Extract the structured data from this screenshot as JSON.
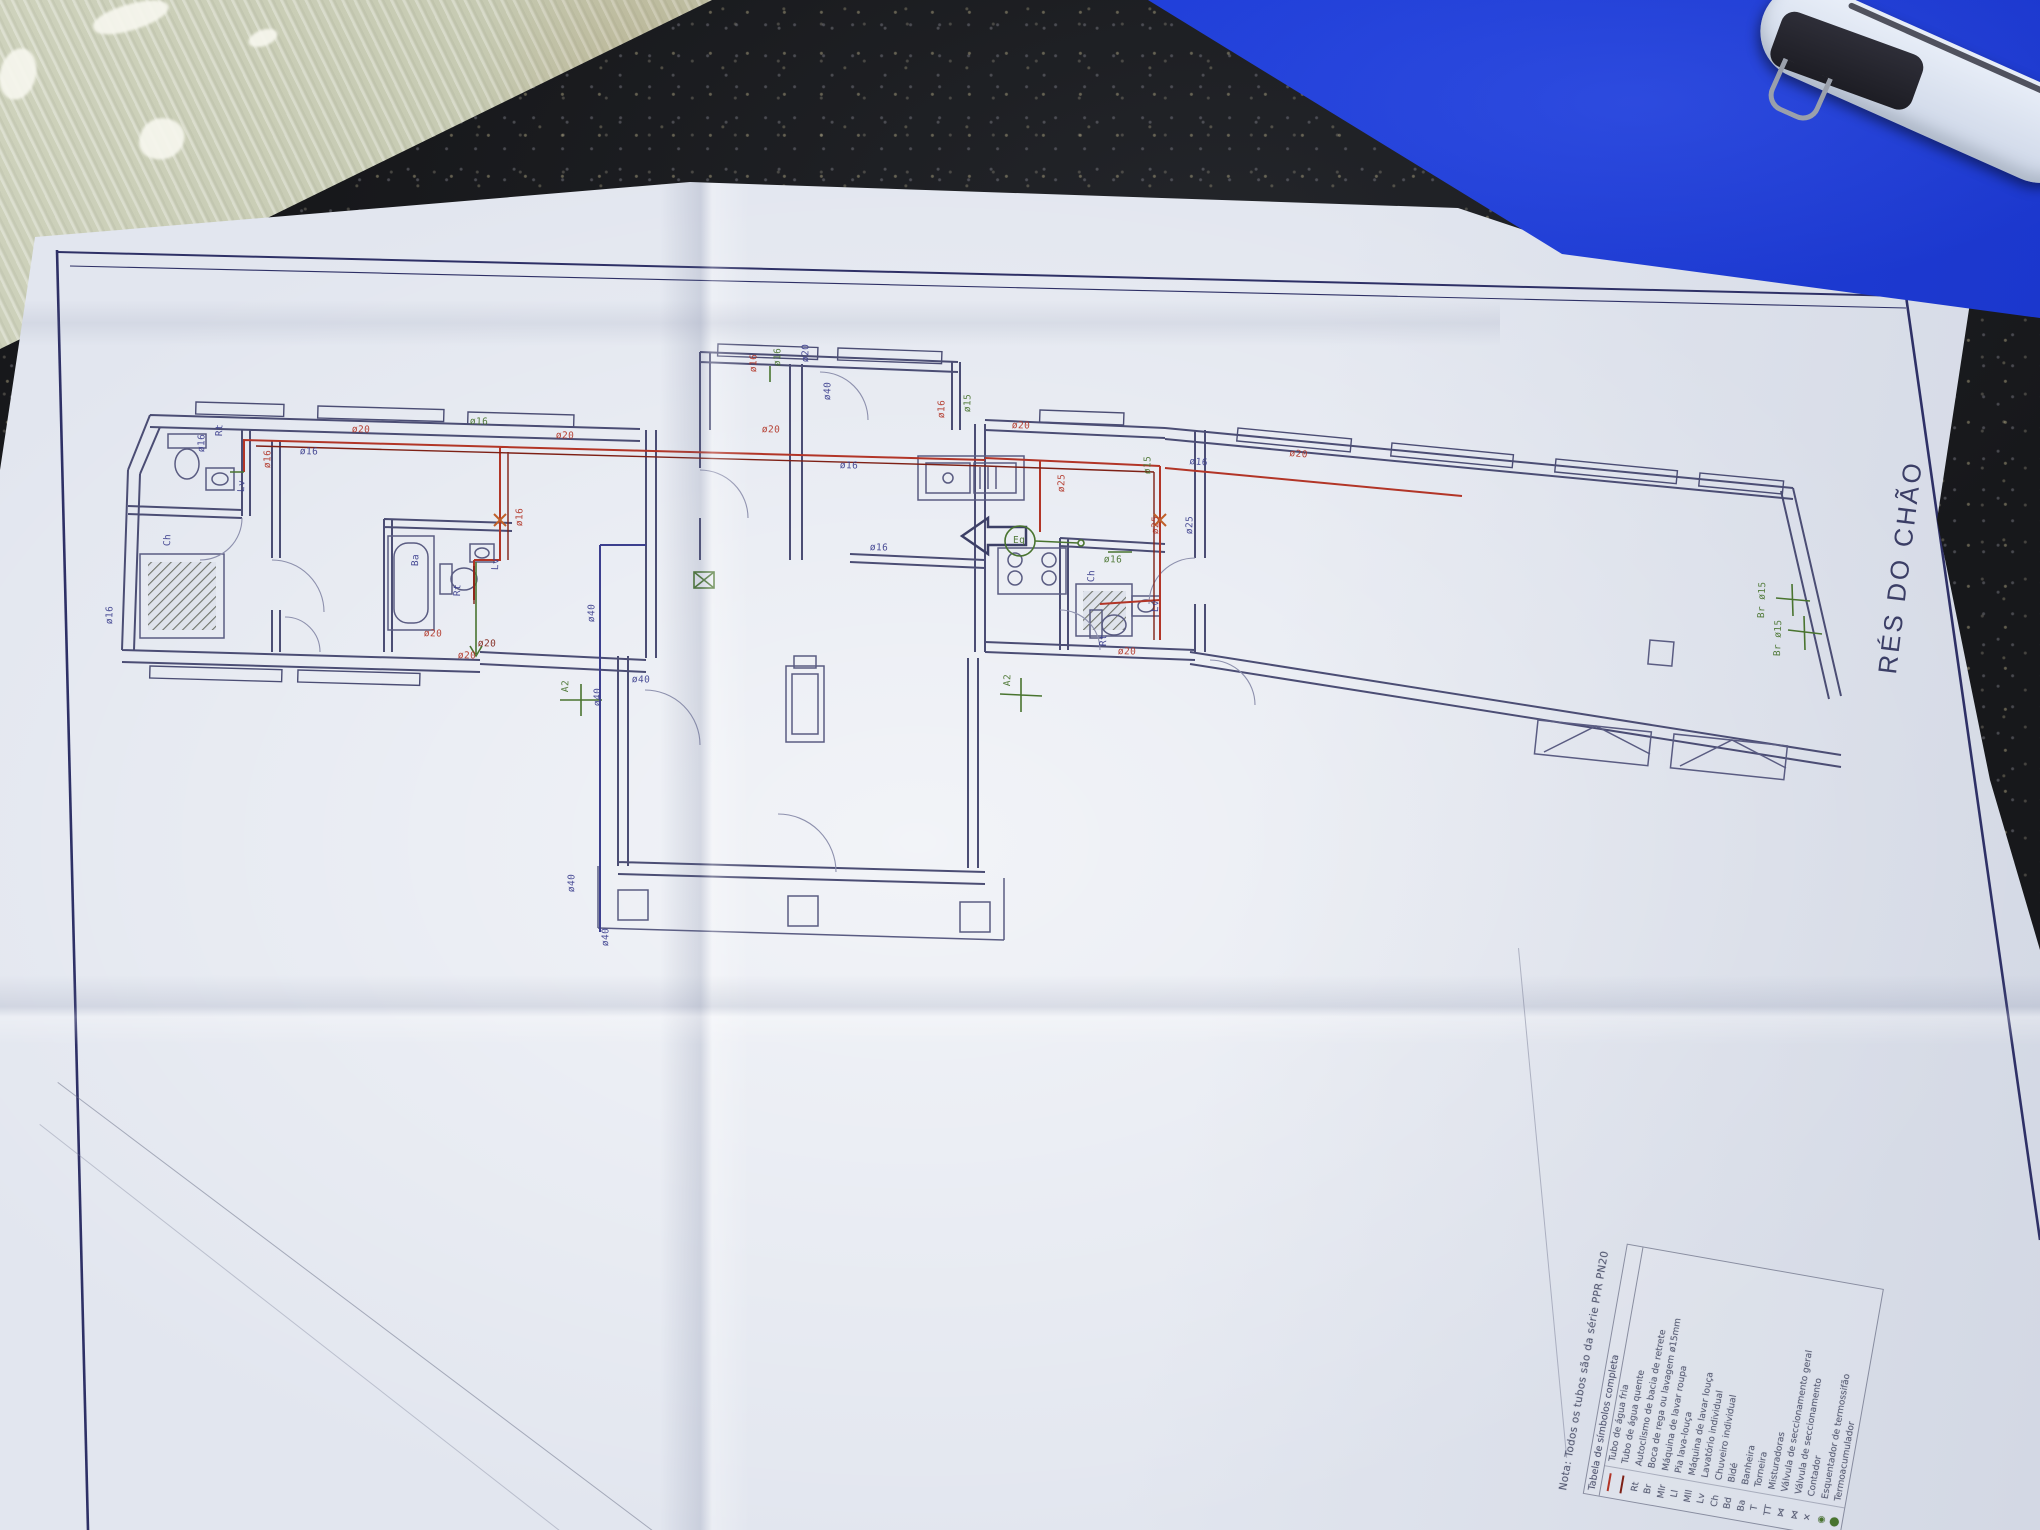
{
  "drawing": {
    "title": "RÉS DO CHÃO",
    "note": "Nota: Todos os tubos são da série PPR PN20",
    "legend": {
      "header": "Tabela de símbolos completa",
      "rows": [
        {
          "symbol": "",
          "text": "Tubo de água fria",
          "swatch": "#b23527"
        },
        {
          "symbol": "",
          "text": "Tubo de água quente",
          "swatch": "#7e2015"
        },
        {
          "symbol": "Rt",
          "text": "Autoclismo de bacia de retrete"
        },
        {
          "symbol": "Br",
          "text": "Boca de rega ou lavagem ø15mm"
        },
        {
          "symbol": "Mlr",
          "text": "Máquina de lavar roupa"
        },
        {
          "symbol": "Ll",
          "text": "Pia lava-louça"
        },
        {
          "symbol": "Mll",
          "text": "Máquina de lavar louça"
        },
        {
          "symbol": "Lv",
          "text": "Lavatório individual"
        },
        {
          "symbol": "Ch",
          "text": "Chuveiro individual"
        },
        {
          "symbol": "Bd",
          "text": "Bidé"
        },
        {
          "symbol": "Ba",
          "text": "Banheira"
        },
        {
          "symbol": "T",
          "text": "Torneira"
        },
        {
          "symbol": "TT",
          "text": "Misturadoras"
        },
        {
          "symbol": "⋈",
          "text": "Válvula de seccionamento geral"
        },
        {
          "symbol": "⋈",
          "text": "Válvula de seccionamento"
        },
        {
          "symbol": "✕",
          "text": "Contador"
        },
        {
          "symbol": "◉",
          "text": "Esquentador de termossifão",
          "green": true
        },
        {
          "symbol": "⬤",
          "text": "Termoacumulador",
          "green": true
        }
      ]
    },
    "labels": [
      {
        "t": "ø20",
        "x": 352,
        "y": 424,
        "r": 2,
        "c": "red"
      },
      {
        "t": "ø16",
        "x": 300,
        "y": 446,
        "r": 2,
        "c": "blue"
      },
      {
        "t": "ø20",
        "x": 556,
        "y": 430,
        "r": 2,
        "c": "red"
      },
      {
        "t": "ø16",
        "x": 470,
        "y": 416,
        "r": 2,
        "c": "green"
      },
      {
        "t": "ø16",
        "x": 196,
        "y": 452,
        "r": -88,
        "c": "blue"
      },
      {
        "t": "ø16",
        "x": 262,
        "y": 468,
        "r": -88,
        "c": "red"
      },
      {
        "t": "Rt",
        "x": 214,
        "y": 436,
        "r": -88,
        "c": "blue"
      },
      {
        "t": "Lv",
        "x": 236,
        "y": 492,
        "r": -88,
        "c": "blue"
      },
      {
        "t": "Ch",
        "x": 162,
        "y": 546,
        "r": -88,
        "c": "blue"
      },
      {
        "t": "ø16",
        "x": 104,
        "y": 624,
        "r": -88,
        "c": "blue"
      },
      {
        "t": "Ba",
        "x": 410,
        "y": 566,
        "r": -88,
        "c": "blue"
      },
      {
        "t": "Rt",
        "x": 452,
        "y": 596,
        "r": -88,
        "c": "blue"
      },
      {
        "t": "Lv",
        "x": 490,
        "y": 570,
        "r": -88,
        "c": "blue"
      },
      {
        "t": "ø20",
        "x": 424,
        "y": 628,
        "r": 2,
        "c": "red"
      },
      {
        "t": "ø20",
        "x": 478,
        "y": 638,
        "r": 2,
        "c": "dred"
      },
      {
        "t": "ø16",
        "x": 514,
        "y": 526,
        "r": -88,
        "c": "red"
      },
      {
        "t": "ø20",
        "x": 458,
        "y": 650,
        "r": 2,
        "c": "red"
      },
      {
        "t": "ø20",
        "x": 762,
        "y": 424,
        "r": 2,
        "c": "red"
      },
      {
        "t": "ø16",
        "x": 840,
        "y": 460,
        "r": 2,
        "c": "blue"
      },
      {
        "t": "ø20",
        "x": 1012,
        "y": 420,
        "r": 2,
        "c": "red"
      },
      {
        "t": "ø16",
        "x": 748,
        "y": 372,
        "r": -88,
        "c": "red"
      },
      {
        "t": "ø16",
        "x": 772,
        "y": 366,
        "r": -88,
        "c": "green"
      },
      {
        "t": "ø20",
        "x": 800,
        "y": 362,
        "r": -88,
        "c": "blue"
      },
      {
        "t": "ø16",
        "x": 936,
        "y": 418,
        "r": -88,
        "c": "red"
      },
      {
        "t": "ø15",
        "x": 962,
        "y": 412,
        "r": -88,
        "c": "green"
      },
      {
        "t": "ø25",
        "x": 1056,
        "y": 492,
        "r": -88,
        "c": "red"
      },
      {
        "t": "Eq",
        "x": 1013,
        "y": 535,
        "r": 0,
        "c": "green"
      },
      {
        "t": "ø40",
        "x": 586,
        "y": 622,
        "r": -88,
        "c": "blue"
      },
      {
        "t": "ø40",
        "x": 592,
        "y": 706,
        "r": -88,
        "c": "blue"
      },
      {
        "t": "ø40",
        "x": 566,
        "y": 892,
        "r": -88,
        "c": "blue"
      },
      {
        "t": "A2",
        "x": 560,
        "y": 692,
        "r": -88,
        "c": "green"
      },
      {
        "t": "A2",
        "x": 1002,
        "y": 686,
        "r": -88,
        "c": "green"
      },
      {
        "t": "ø40",
        "x": 632,
        "y": 674,
        "r": 2,
        "c": "blue"
      },
      {
        "t": "ø16",
        "x": 870,
        "y": 542,
        "r": 2,
        "c": "blue"
      },
      {
        "t": "ø20",
        "x": 1290,
        "y": 448,
        "r": 5,
        "c": "red"
      },
      {
        "t": "ø16",
        "x": 1190,
        "y": 456,
        "r": 5,
        "c": "blue"
      },
      {
        "t": "ø15",
        "x": 1142,
        "y": 474,
        "r": -88,
        "c": "green"
      },
      {
        "t": "ø25",
        "x": 1150,
        "y": 534,
        "r": -88,
        "c": "red"
      },
      {
        "t": "ø25",
        "x": 1184,
        "y": 534,
        "r": -88,
        "c": "blue"
      },
      {
        "t": "Ch",
        "x": 1086,
        "y": 582,
        "r": -88,
        "c": "blue"
      },
      {
        "t": "Rt",
        "x": 1098,
        "y": 646,
        "r": -88,
        "c": "blue"
      },
      {
        "t": "Lv",
        "x": 1150,
        "y": 612,
        "r": -88,
        "c": "blue"
      },
      {
        "t": "ø16",
        "x": 1104,
        "y": 554,
        "r": 2,
        "c": "green"
      },
      {
        "t": "ø20",
        "x": 1118,
        "y": 646,
        "r": 2,
        "c": "red"
      },
      {
        "t": "Br ø15",
        "x": 1756,
        "y": 618,
        "r": -88,
        "c": "green"
      },
      {
        "t": "Br ø15",
        "x": 1772,
        "y": 656,
        "r": -88,
        "c": "green"
      },
      {
        "t": "ø40",
        "x": 822,
        "y": 400,
        "r": -88,
        "c": "blue"
      },
      {
        "t": "ø40",
        "x": 600,
        "y": 946,
        "r": -88,
        "c": "blue"
      }
    ],
    "colors": {
      "cold_water": "#b23527",
      "hot_water": "#7e2015",
      "fitting_green": "#49742f",
      "annotation_blue": "#3c3f8e",
      "drain_blue": "#3c3f8e",
      "wall": "#4b4d74",
      "frame": "#2e3066",
      "folder_blue": "#1e3ad0",
      "cardboard": "#c7cbb3",
      "countertop": "#17181b",
      "paper": "#e2e6ef"
    }
  }
}
